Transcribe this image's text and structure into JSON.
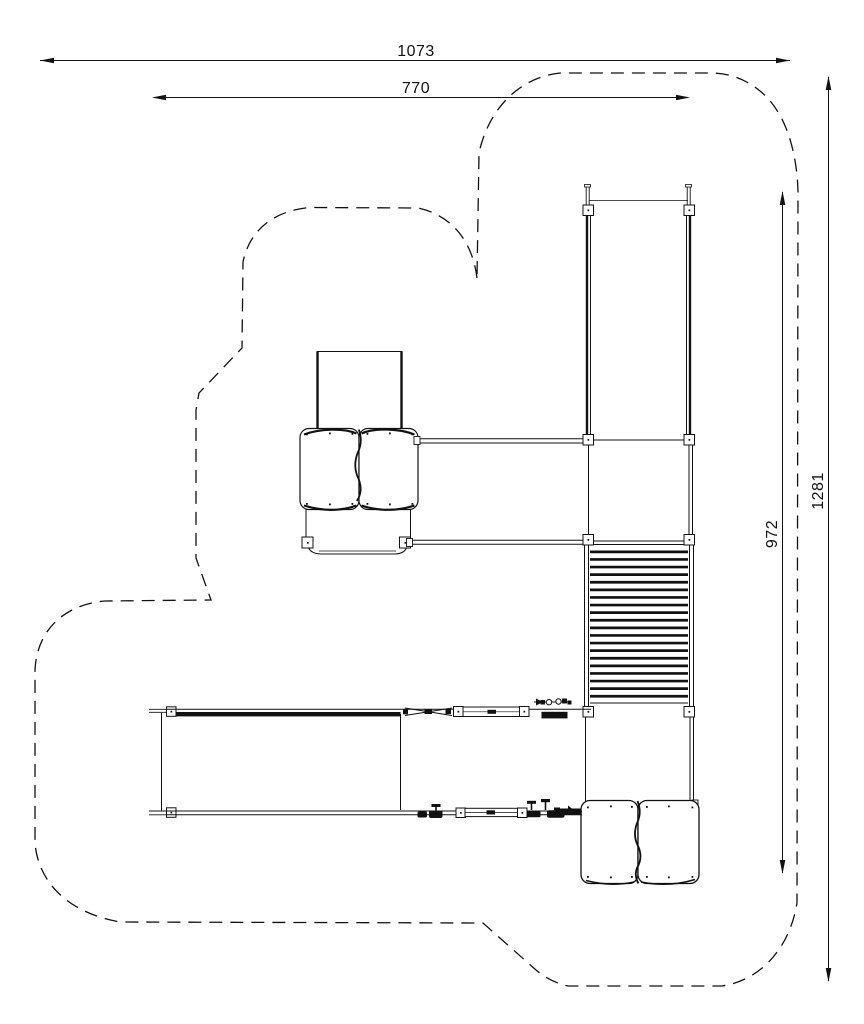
{
  "drawing": {
    "type": "playground-equipment-plan-view",
    "dimensions": {
      "overall_width": "1073",
      "inner_width": "770",
      "overall_height": "1281",
      "inner_height": "972"
    }
  },
  "colors": {
    "line": "#111111",
    "background": "#ffffff"
  }
}
